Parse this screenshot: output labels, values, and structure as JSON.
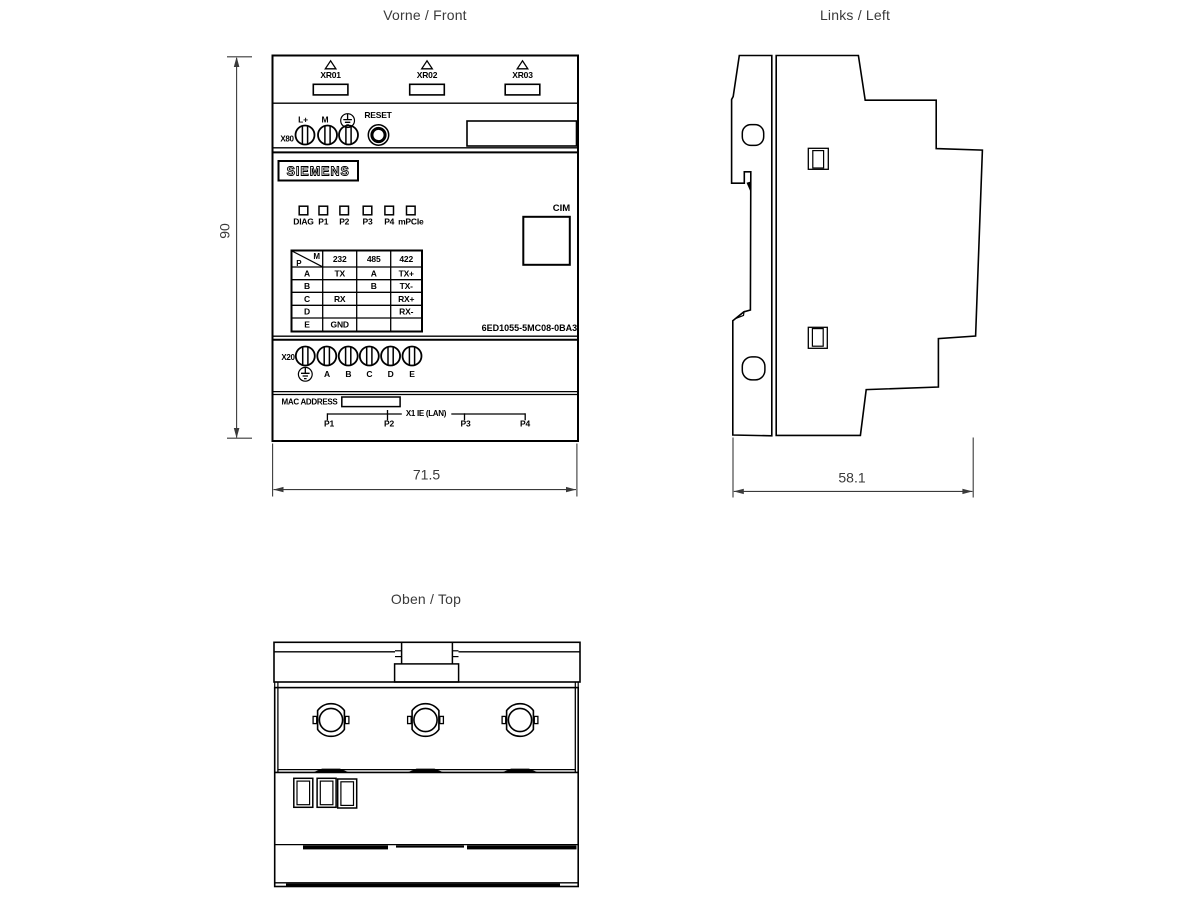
{
  "titles": {
    "front": "Vorne / Front",
    "left": "Links / Left",
    "top": "Oben / Top"
  },
  "dimensions": {
    "height_mm": "90",
    "width_mm": "71.5",
    "depth_mm": "58.1"
  },
  "front": {
    "antenna_ports": [
      {
        "label": "XR01"
      },
      {
        "label": "XR02"
      },
      {
        "label": "XR03"
      }
    ],
    "power": {
      "connector_label": "X80",
      "plus_label": "L+",
      "m_label": "M",
      "reset_label": "RESET"
    },
    "brand": "SIEMENS",
    "led_labels": [
      "DIAG",
      "P1",
      "P2",
      "P3",
      "P4",
      "mPCIe"
    ],
    "cim_label": "CIM",
    "part_number": "6ED1055-5MC08-0BA3",
    "pin_table": {
      "corner_top_right": "M",
      "corner_bottom_left": "P",
      "columns": [
        "232",
        "485",
        "422"
      ],
      "rows": [
        {
          "pin": "A",
          "c232": "TX",
          "c485": "A",
          "c422": "TX+"
        },
        {
          "pin": "B",
          "c232": "",
          "c485": "B",
          "c422": "TX-"
        },
        {
          "pin": "C",
          "c232": "RX",
          "c485": "",
          "c422": "RX+"
        },
        {
          "pin": "D",
          "c232": "",
          "c485": "",
          "c422": "RX-"
        },
        {
          "pin": "E",
          "c232": "GND",
          "c485": "",
          "c422": ""
        }
      ]
    },
    "io_block": {
      "connector_label": "X20",
      "pin_labels": [
        "A",
        "B",
        "C",
        "D",
        "E"
      ]
    },
    "bottom": {
      "mac_label": "MAC ADDRESS",
      "lan_label": "X1 IE (LAN)",
      "port_labels": [
        "P1",
        "P2",
        "P3",
        "P4"
      ]
    }
  }
}
